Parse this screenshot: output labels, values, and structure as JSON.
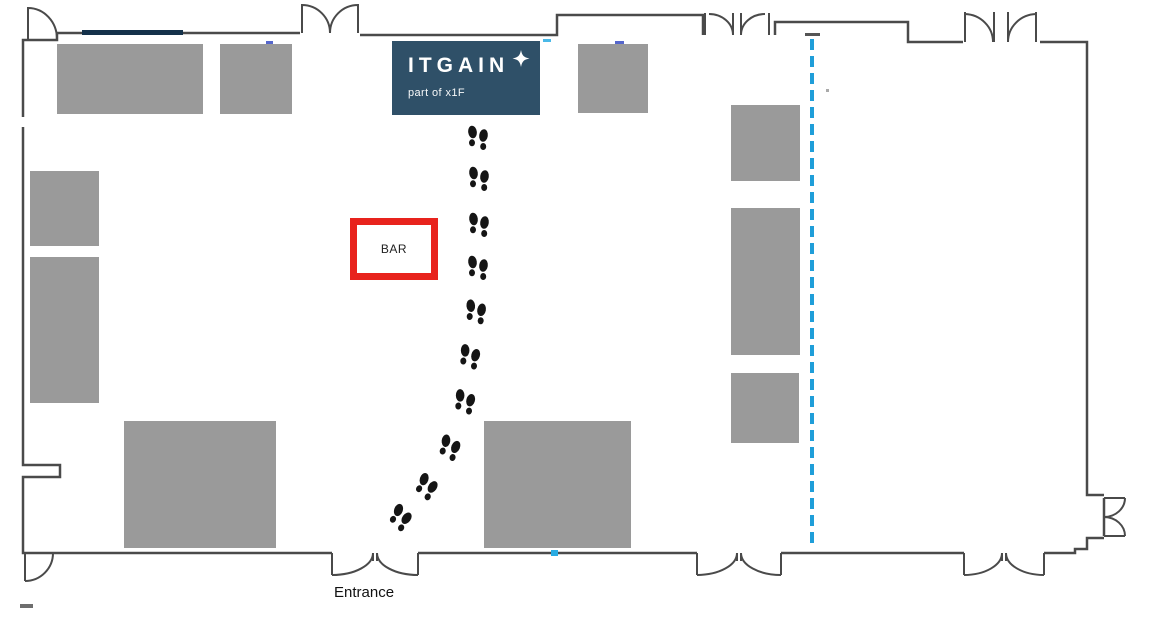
{
  "floorplan": {
    "itgain_booth": {
      "name": "ITGAIN",
      "tagline": "part of x1F",
      "bg_color": "#2f5068",
      "x": 392,
      "y": 41,
      "w": 148,
      "h": 74
    },
    "bar": {
      "label": "BAR",
      "border_color": "#e8231d",
      "x": 350,
      "y": 218,
      "w": 88,
      "h": 62
    },
    "entrance": {
      "label": "Entrance",
      "x": 334,
      "y": 584
    },
    "colors": {
      "booth_gray": "#9a9a9a",
      "wall": "#4a4a4a",
      "path_blue": "#1f9ed9",
      "footprint": "#151515",
      "navy_wall_accent": "#14314a"
    },
    "dashed_line": {
      "x": 812,
      "y1": 39,
      "y2": 545
    },
    "booths": [
      {
        "x": 57,
        "y": 44,
        "w": 146,
        "h": 70
      },
      {
        "x": 220,
        "y": 44,
        "w": 72,
        "h": 70
      },
      {
        "x": 578,
        "y": 44,
        "w": 70,
        "h": 69
      },
      {
        "x": 30,
        "y": 171,
        "w": 69,
        "h": 75
      },
      {
        "x": 30,
        "y": 257,
        "w": 69,
        "h": 146
      },
      {
        "x": 124,
        "y": 421,
        "w": 152,
        "h": 127
      },
      {
        "x": 484,
        "y": 421,
        "w": 147,
        "h": 127
      },
      {
        "x": 731,
        "y": 105,
        "w": 69,
        "h": 76
      },
      {
        "x": 731,
        "y": 208,
        "w": 69,
        "h": 147
      },
      {
        "x": 731,
        "y": 373,
        "w": 68,
        "h": 70
      }
    ],
    "footprints": [
      {
        "x": 478,
        "y": 137,
        "rot": 0
      },
      {
        "x": 479,
        "y": 178,
        "rot": 0
      },
      {
        "x": 479,
        "y": 224,
        "rot": 0
      },
      {
        "x": 478,
        "y": 267,
        "rot": 0
      },
      {
        "x": 476,
        "y": 311,
        "rot": 3
      },
      {
        "x": 470,
        "y": 356,
        "rot": 7
      },
      {
        "x": 465,
        "y": 401,
        "rot": 7
      },
      {
        "x": 450,
        "y": 447,
        "rot": 15
      },
      {
        "x": 427,
        "y": 486,
        "rot": 25
      },
      {
        "x": 401,
        "y": 517,
        "rot": 28
      }
    ]
  }
}
